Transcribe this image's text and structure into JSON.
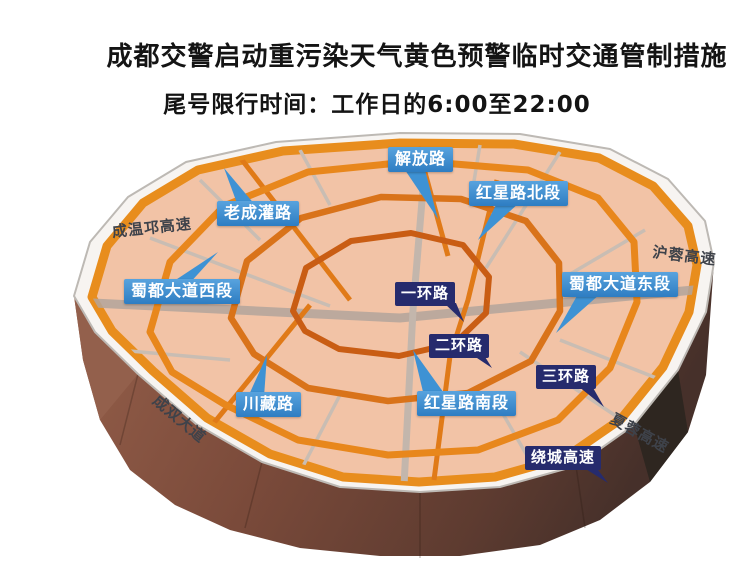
{
  "title": {
    "line1": "成都交警启动重污染天气黄色预警临时交通管制措施",
    "line2": "尾号限行时间：工作日的6:00至22:00"
  },
  "map": {
    "callouts_blue": {
      "jiefanglu": "解放路",
      "hongxinglu_north": "红星路北段",
      "laochengguanlu": "老成灌路",
      "shududadao_west": "蜀都大道西段",
      "shududadao_east": "蜀都大道东段",
      "hongxinglu_south": "红星路南段",
      "chuanzanglu": "川藏路"
    },
    "callouts_navy": {
      "yihuanlu": "一环路",
      "erhuanlu": "二环路",
      "sanhuanlu": "三环路",
      "raocheng_expressway": "绕城高速"
    },
    "road_texts": {
      "chengwenqiong_expressway": "成温邛高速",
      "hurong_expressway": "沪蓉高速",
      "xiarong_expressway": "夏蓉高速",
      "chengshuang_avenue": "成双大道"
    },
    "colors": {
      "surface_salmon": "#f2c3a6",
      "rim_white": "#f7f4f1",
      "ring_orange": "#e88d1d",
      "inner_ring_orange": "#c95d14",
      "callout_blue": "#3e92d4",
      "callout_navy": "#262b6d",
      "base_brown": "#7a4a3a",
      "road_gray": "#c9bdb3"
    }
  }
}
